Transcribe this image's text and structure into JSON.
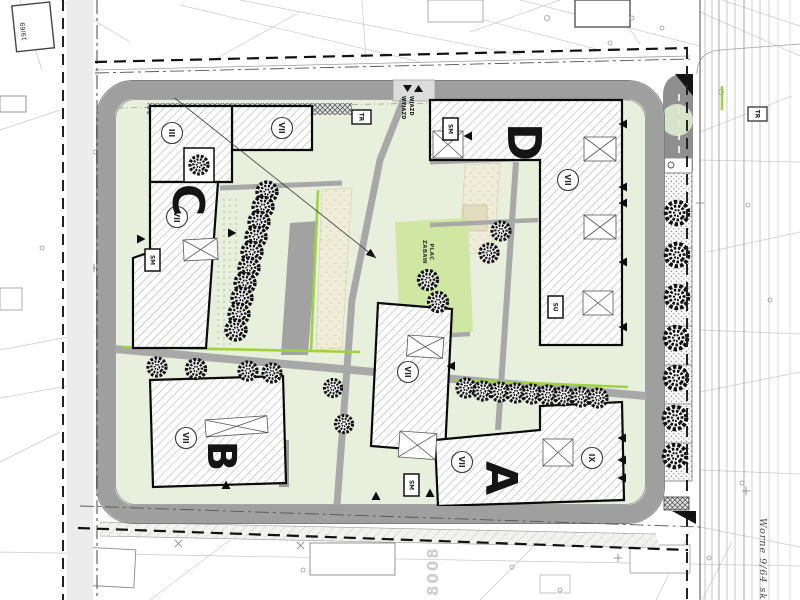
{
  "plan": {
    "letters": {
      "a": "A",
      "b": "B",
      "c": "C",
      "d": "D"
    },
    "storeys": {
      "c_top": "III",
      "c_wing": "VII",
      "c_main": "VII",
      "d_main": "VII",
      "b_main": "VII",
      "center_main": "VII",
      "a_main": "VII",
      "a_right": "IX"
    },
    "boxes": {
      "sm": "SM",
      "su": "SU",
      "tr": "TR"
    },
    "playground": {
      "line1": "PLAC",
      "line2": "ZABAW"
    },
    "gate": {
      "in": "WJAZD",
      "out": "WYJAZD"
    },
    "margins": {
      "parcel_top_left": "19/69",
      "street_name_right": "Worne 9/64 sko",
      "faint_number_bottom": "8008"
    },
    "colors": {
      "courtyard": "#e9efdd",
      "playground": "#cfe7a3",
      "accent_green": "#9ed23e",
      "road_ring": "#9f9f9f",
      "dark_road": "#8f8f8f",
      "green_circle": "#dde9cf"
    }
  }
}
